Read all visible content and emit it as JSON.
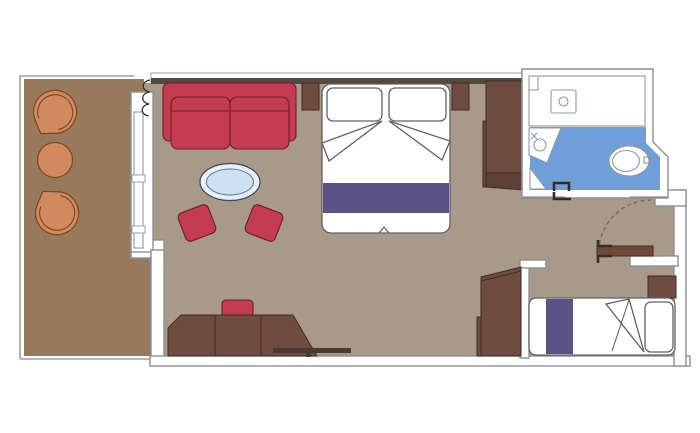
{
  "plan": {
    "type": "cruise-cabin-floor-plan",
    "rooms": [
      "balcony",
      "living-area",
      "sleeping-area",
      "bathroom",
      "entry-vestibule",
      "second-bedroom"
    ],
    "furniture": [
      "balcony-chairs",
      "balcony-table",
      "sofa",
      "coffee-table",
      "ottomans",
      "desk",
      "desk-stool",
      "double-bed",
      "nightstands",
      "wardrobe",
      "shower",
      "washbasin",
      "toilet",
      "entry-door",
      "single-bed",
      "pillow",
      "folded-blanket"
    ]
  },
  "palette": {
    "floor_living": "#a89a89",
    "floor_balcony": "#97795c",
    "furniture_wood": "#6e4c3f",
    "wood_dark_base": "#5d4136",
    "door_wood": "#6f4a38",
    "shelf_dark": "#4a3a30",
    "sofa_red": "#c43c4f",
    "chair_orange": "#d08a5d",
    "bed_purple": "#5b5286",
    "bathroom_blue": "#6f9ed9",
    "window_glass": "#cfdeee",
    "table_glass": "#cfe0f2",
    "table_rim": "#e9eff7",
    "wall_dark": "#564a40",
    "wall_white": "#ffffff"
  }
}
